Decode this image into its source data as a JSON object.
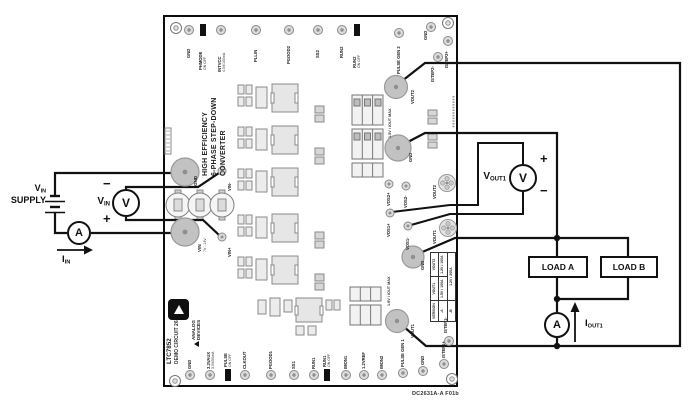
{
  "caption": "DC2631A-A F01b",
  "external": {
    "supply": {
      "sym": "V",
      "sub": "IN",
      "line2": "SUPPLY"
    },
    "vin_meter": {
      "glyph": "V",
      "label": "V",
      "label_sub": "IN",
      "minus": "−",
      "plus": "+"
    },
    "ammeter_glyph": "A",
    "iin": {
      "label": "I",
      "sub": "IN"
    },
    "vout1_meter": {
      "glyph": "V",
      "label": "V",
      "label_sub": "OUT1",
      "plus": "+",
      "minus": "−"
    },
    "iout1": {
      "label": "I",
      "sub": "OUT1"
    },
    "load_a": "LOAD A",
    "load_b": "LOAD B"
  },
  "board": {
    "title_lines": [
      "HIGH EFFICIENCY",
      "6-PHASE STEP-DOWN",
      "CONVERTER"
    ],
    "part_number": "LTC7852",
    "demo_circuit": "DEMO CIRCUIT 2631A-A",
    "brand": {
      "line1": "ANALOG",
      "line2": "DEVICES"
    },
    "top_turrets": [
      "GND",
      "PLLIN",
      "PGOOD2",
      "SS2",
      "RUN2",
      "PULSE GEN 2",
      "GND",
      "ISTEP2+",
      "ISTEP2-"
    ],
    "top_jumpers": [
      {
        "name": "PHMODE",
        "state": "ON OFF"
      },
      {
        "name": "RUN2",
        "state": "ON OFF"
      }
    ],
    "intvcc": {
      "name": "INTVCC",
      "rating": "4.5V/100mA"
    },
    "aux": {
      "name": "3.3VAUX",
      "rating": "3.3V/50mA"
    },
    "bottom_turrets": [
      "GND",
      "CLKOUT",
      "PGOOD1",
      "SS1",
      "RUN1",
      "IMON1",
      "1.2VREF",
      "IMON2",
      "PULSE GEN 1",
      "GND",
      "ISTEP1+",
      "ISTEP1-"
    ],
    "bottom_jumpers": [
      {
        "name": "PULSE",
        "state": "ON OFF"
      },
      {
        "name": "RUN1",
        "state": "ON OFF"
      }
    ],
    "pads": {
      "gnd_in": "GND",
      "vin": "VIN",
      "vin_range": "7V - 14V",
      "vin_s_minus": "VIN-",
      "vin_s_plus": "VIN+",
      "vout2": "VOUT2",
      "gnd_out2": "GND",
      "vos2p": "VOS2+",
      "vos2m": "VOS2-",
      "vout2_jack": "VOUT2",
      "vos1p": "VOS1+",
      "vos1m": "VOS1-",
      "vout1_jack": "VOUT1",
      "gnd_out1": "GND",
      "vout1": "VOUT1"
    },
    "options": {
      "vout2_area": "1.5V / IOUT MAX",
      "vout1_area": "1.8V / IOUT MAX"
    },
    "table": {
      "h": [
        "VERSION",
        "VOUT1",
        "VOUT2"
      ],
      "row_a": [
        "-A",
        "1.5V / 100A",
        "1.2V / 100A"
      ],
      "row_b": [
        "-B",
        "1.2V / 200A"
      ]
    }
  }
}
